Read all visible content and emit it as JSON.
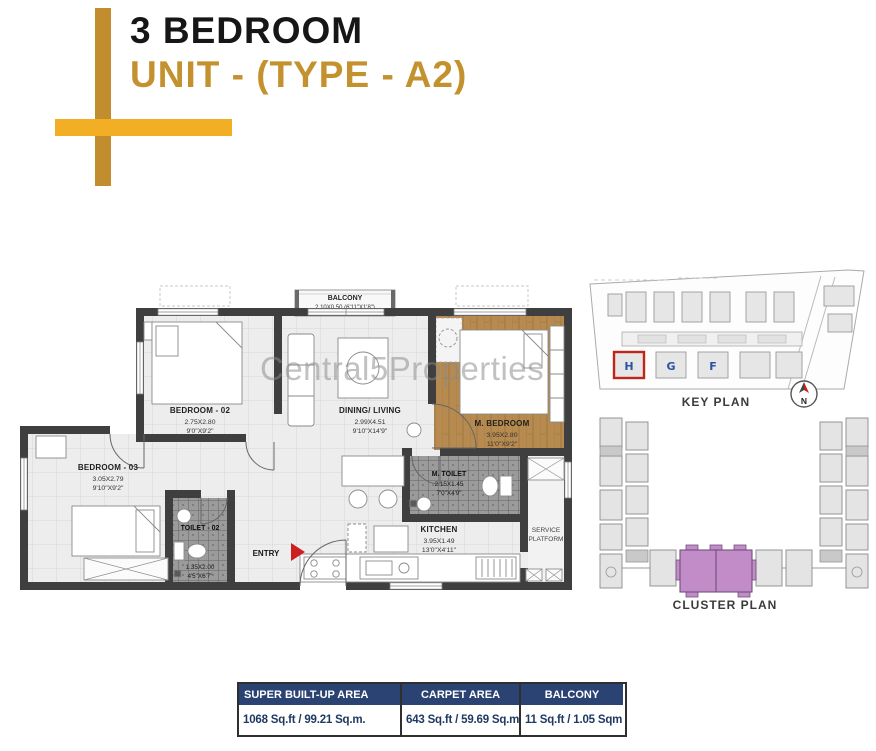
{
  "header": {
    "title": "3 BEDROOM",
    "subtitle": "UNIT - (TYPE - A2)",
    "colors": {
      "title": "#161616",
      "subtitle_gold": "#c3922e",
      "cross_vertical_gold": "#c18d2e",
      "cross_horizontal_gold": "#f2ae24"
    }
  },
  "watermark": {
    "text": "Central5Properties",
    "color": "#8a8a8a"
  },
  "floor_plan": {
    "colors": {
      "wall": "#3f3f3f",
      "wood_floor": "#b78b50",
      "toilet_tile": "#9b9b9b",
      "entry_arrow_red": "#cc1f1f"
    },
    "rooms": {
      "balcony": {
        "name": "BALCONY",
        "dims": "2.10X0.50 (6'11\"X1'8\")"
      },
      "bedroom2": {
        "name": "BEDROOM - 02",
        "dims_m": "2.75X2.80",
        "dims_ft": "9'0\"X9'2\""
      },
      "dining_living": {
        "name": "DINING/ LIVING",
        "dims_m": "2.99X4.51",
        "dims_ft": "9'10\"X14'9\""
      },
      "master_bedroom": {
        "name": "M. BEDROOM",
        "dims_m": "3.95X2.80",
        "dims_ft": "11'0\"X9'2\""
      },
      "master_toilet": {
        "name": "M. TOILET",
        "dims_m": "2.15X1.45",
        "dims_ft": "7'0\"X4'9\""
      },
      "bedroom3": {
        "name": "BEDROOM - 03",
        "dims_m": "3.05X2.79",
        "dims_ft": "9'10\"X9'2\""
      },
      "toilet2": {
        "name": "TOILET - 02",
        "dims_m": "1.35X2.00",
        "dims_ft": "4'5\"X6'7\""
      },
      "kitchen": {
        "name": "KITCHEN",
        "dims_m": "3.95X1.49",
        "dims_ft": "13'0\"X4'11\""
      },
      "service_platform": {
        "line1": "SERVICE",
        "line2": "PLATFORM"
      },
      "entry": "ENTRY"
    }
  },
  "key_plan": {
    "label": "KEY PLAN",
    "compass": "N",
    "buildings": [
      "H",
      "G",
      "F"
    ],
    "highlight_color": "#c0251c",
    "letter_color": "#2b52a3"
  },
  "cluster_plan": {
    "label": "CLUSTER PLAN",
    "highlight_color": "#c18cc7"
  },
  "area_table": {
    "header_bg": "#2b4372",
    "value_text_color": "#1e3a63",
    "columns": [
      {
        "header": "SUPER BUILT-UP AREA",
        "value": "1068 Sq.ft / 99.21 Sq.m."
      },
      {
        "header": "CARPET AREA",
        "value": "643 Sq.ft / 59.69 Sq.m"
      },
      {
        "header": "BALCONY",
        "value": "11 Sq.ft / 1.05 Sqm"
      }
    ]
  }
}
